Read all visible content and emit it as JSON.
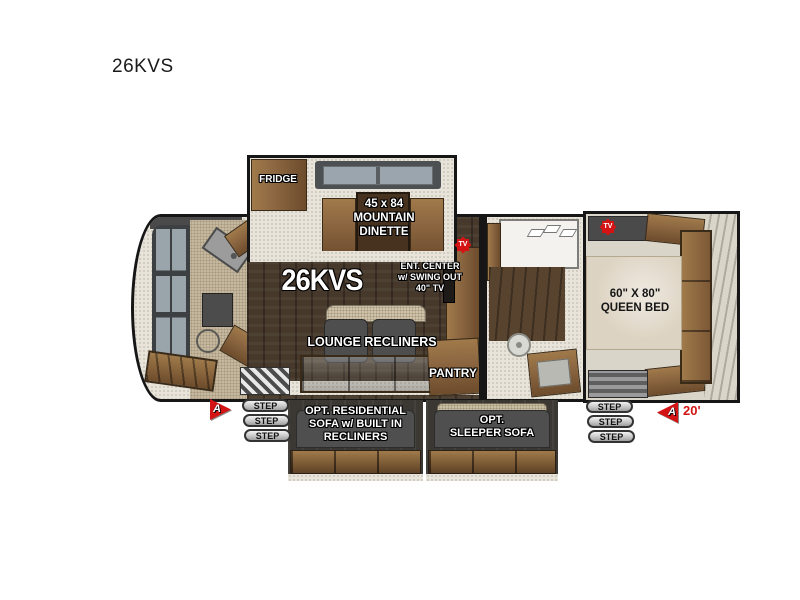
{
  "page": {
    "title": "26KVS"
  },
  "colors": {
    "accent_red": "#d41414",
    "outline_black": "#161616",
    "wood_brown": "#8a6540",
    "floor_dark": "#46392c",
    "carpet_beige": "#c6b89e",
    "furniture_gray": "#4e4e4e"
  },
  "floorplan": {
    "model_label": "26KVS",
    "slideout": {
      "fridge_label": "FRIDGE",
      "dinette_label": "45 x 84\nMOUNTAIN\nDINETTE"
    },
    "living": {
      "ent_center_label": "ENT. CENTER\nw/ SWING OUT\n40\" TV",
      "lounge_label": "LOUNGE RECLINERS",
      "pantry_label": "PANTRY"
    },
    "bedroom": {
      "bed_label": "60\" X 80\"\nQUEEN BED"
    },
    "tv_badge": "TV",
    "steps": {
      "label": "STEP"
    },
    "options": {
      "residential_sofa_label": "OPT. RESIDENTIAL\nSOFA w/ BUILT IN\nRECLINERS",
      "sleeper_sofa_label": "OPT.\nSLEEPER SOFA"
    },
    "awning": {
      "marker": "A",
      "length": "20'"
    }
  }
}
